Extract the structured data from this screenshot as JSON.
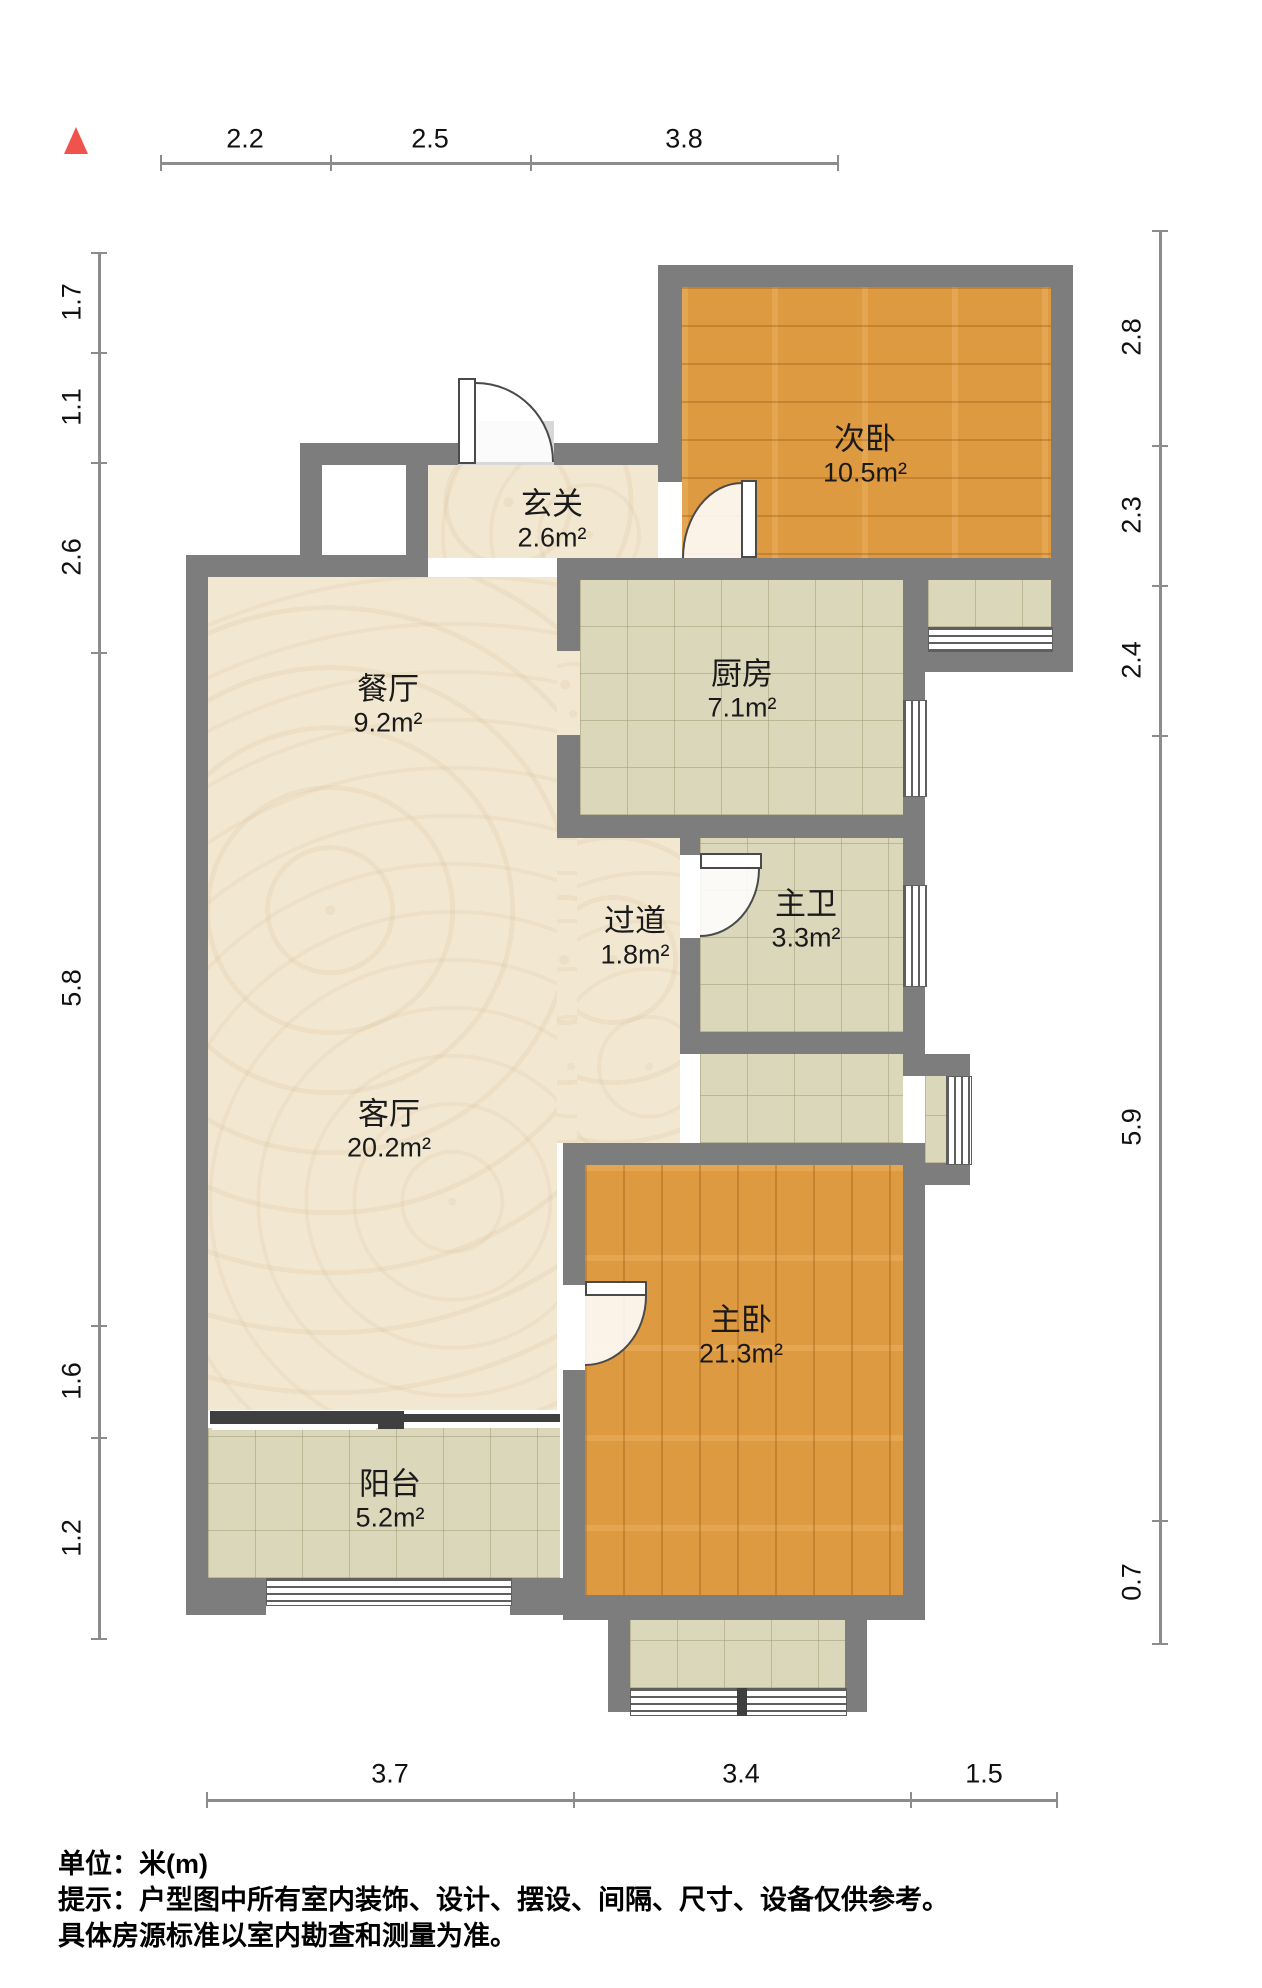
{
  "plan": {
    "title": "户型图",
    "rooms": {
      "ciwo": {
        "name": "次卧",
        "area": "10.5m²"
      },
      "xuanguan": {
        "name": "玄关",
        "area": "2.6m²"
      },
      "chufang": {
        "name": "厨房",
        "area": "7.1m²"
      },
      "canting": {
        "name": "餐厅",
        "area": "9.2m²"
      },
      "guodao": {
        "name": "过道",
        "area": "1.8m²"
      },
      "zhuwei": {
        "name": "主卫",
        "area": "3.3m²"
      },
      "keting": {
        "name": "客厅",
        "area": "20.2m²"
      },
      "zhuwo": {
        "name": "主卧",
        "area": "21.3m²"
      },
      "yangtai": {
        "name": "阳台",
        "area": "5.2m²"
      }
    },
    "dimensions": {
      "top": [
        "2.2",
        "2.5",
        "3.8"
      ],
      "left": [
        "1.7",
        "1.1",
        "2.6",
        "5.8",
        "1.6",
        "1.2"
      ],
      "right": [
        "2.8",
        "2.3",
        "2.4",
        "5.9",
        "0.7"
      ],
      "bottom": [
        "3.7",
        "3.4",
        "1.5"
      ]
    },
    "colors": {
      "wall": "#7d7d7d",
      "wood_floor": "#de9a40",
      "tile_floor": "#dbd7ba",
      "marble_floor": "#f2e8d2",
      "north_arrow": "#f0524e",
      "dimension_line": "#8c8c8c"
    }
  },
  "footer": {
    "unit": "单位：米(m)",
    "tip_line1": "提示：户型图中所有室内装饰、设计、摆设、间隔、尺寸、设备仅供参考。",
    "tip_line2": "具体房源标准以室内勘查和测量为准。"
  }
}
